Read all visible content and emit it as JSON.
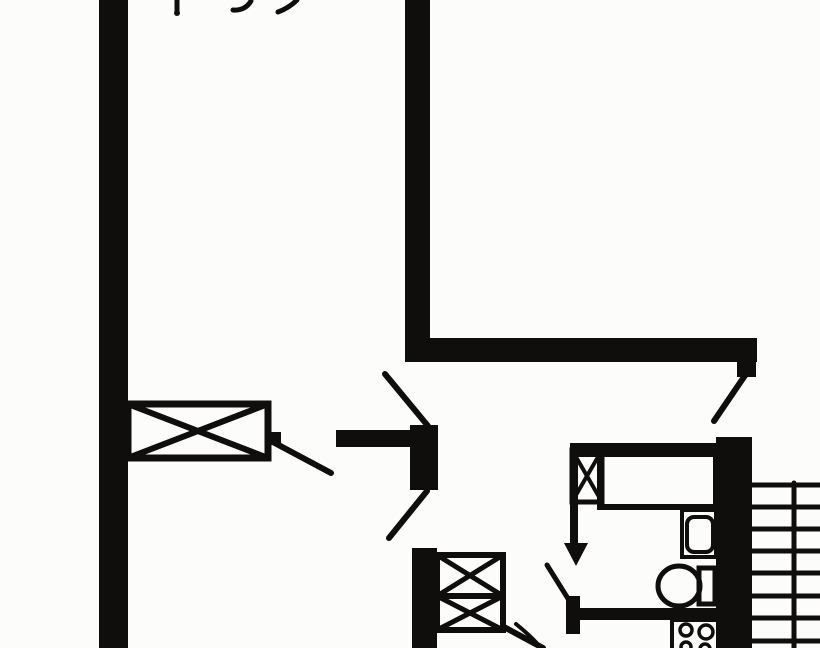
{
  "meta": {
    "document_type": "floor-plan-scan",
    "canvas": {
      "width": 820,
      "height": 648
    },
    "ink_color": "#0f0e0c",
    "paper_color": "#fcfcfa",
    "visible_text": []
  },
  "plan": {
    "elements": [
      {
        "name": "left-wall",
        "kind": "rect",
        "x": 99,
        "y": 0,
        "w": 29,
        "h": 648,
        "fill": true
      },
      {
        "name": "entry-hall-wall-vertical",
        "kind": "rect",
        "x": 405,
        "y": 0,
        "w": 25,
        "h": 362,
        "fill": true
      },
      {
        "name": "entry-hall-wall-horizontal",
        "kind": "rect",
        "x": 405,
        "y": 338,
        "w": 352,
        "h": 24,
        "fill": true
      },
      {
        "name": "stair-door-jamb",
        "kind": "rect",
        "x": 737,
        "y": 362,
        "w": 19,
        "h": 15,
        "fill": true
      },
      {
        "name": "right-wall",
        "kind": "rect",
        "x": 716,
        "y": 437,
        "w": 36,
        "h": 211,
        "fill": true
      },
      {
        "name": "bathroom-top-wall",
        "kind": "rect",
        "x": 570,
        "y": 443,
        "w": 146,
        "h": 14,
        "fill": true
      },
      {
        "name": "bathroom-left-wall",
        "kind": "rect",
        "x": 570,
        "y": 443,
        "w": 8,
        "h": 104,
        "fill": true
      },
      {
        "name": "bathroom-bottom-wall",
        "kind": "rect",
        "x": 578,
        "y": 608,
        "w": 138,
        "h": 12,
        "fill": true
      },
      {
        "name": "hallway-bottom-wall",
        "kind": "rect",
        "x": 412,
        "y": 548,
        "w": 25,
        "h": 100,
        "fill": true
      },
      {
        "name": "center-door-post",
        "kind": "rect",
        "x": 410,
        "y": 425,
        "w": 28,
        "h": 65,
        "fill": true
      },
      {
        "name": "living-room-wall-stub",
        "kind": "rect",
        "x": 336,
        "y": 430,
        "w": 74,
        "h": 17,
        "fill": true
      },
      {
        "name": "bathroom-door-post",
        "kind": "rect",
        "x": 566,
        "y": 596,
        "w": 14,
        "h": 38,
        "fill": true
      },
      {
        "name": "living-room-door-hinge",
        "kind": "rect",
        "x": 268,
        "y": 432,
        "w": 13,
        "h": 13,
        "fill": true
      },
      {
        "name": "window-hatch-box",
        "kind": "xbox",
        "x": 128,
        "y": 404,
        "w": 140,
        "h": 54,
        "sw": 7
      },
      {
        "name": "bathroom-shaft-hatch",
        "kind": "xbox",
        "x": 572,
        "y": 450,
        "w": 30,
        "h": 52,
        "sw": 5
      },
      {
        "name": "hallway-shaft-hatch",
        "kind": "xbox2",
        "x": 437,
        "y": 555,
        "w": 66,
        "h": 75,
        "divider": 596,
        "sw": 6
      },
      {
        "name": "bathtub",
        "kind": "rect",
        "x": 600,
        "y": 450,
        "w": 116,
        "h": 57,
        "sw": 6
      },
      {
        "name": "washbasin",
        "kind": "rect",
        "x": 682,
        "y": 510,
        "w": 34,
        "h": 47,
        "sw": 4
      },
      {
        "name": "washbasin-bowl",
        "kind": "rect",
        "x": 687,
        "y": 517,
        "w": 26,
        "h": 35,
        "rx": 7,
        "sw": 4
      },
      {
        "name": "toilet-bowl",
        "kind": "ellipse",
        "cx": 679,
        "cy": 586,
        "rx": 21,
        "ry": 20,
        "sw": 5
      },
      {
        "name": "toilet-tank",
        "kind": "rect",
        "x": 699,
        "y": 568,
        "w": 16,
        "h": 36,
        "sw": 5
      },
      {
        "name": "stove",
        "kind": "rect",
        "x": 672,
        "y": 620,
        "w": 46,
        "h": 34,
        "sw": 4
      },
      {
        "name": "stove-burner",
        "kind": "circle",
        "cx": 686,
        "cy": 630,
        "r": 6,
        "sw": 3.5
      },
      {
        "name": "stove-burner",
        "kind": "circle",
        "cx": 706,
        "cy": 632,
        "r": 7,
        "sw": 3.5
      },
      {
        "name": "stove-burner",
        "kind": "circle",
        "cx": 686,
        "cy": 647,
        "r": 5,
        "sw": 3.5
      },
      {
        "name": "stove-burner",
        "kind": "circle",
        "cx": 705,
        "cy": 649,
        "r": 5,
        "sw": 3.5
      },
      {
        "name": "stair-tread",
        "kind": "line",
        "x1": 750,
        "y1": 485,
        "x2": 820,
        "y2": 485,
        "sw": 5
      },
      {
        "name": "stair-tread",
        "kind": "line",
        "x1": 750,
        "y1": 507,
        "x2": 820,
        "y2": 507,
        "sw": 5
      },
      {
        "name": "stair-tread",
        "kind": "line",
        "x1": 750,
        "y1": 529,
        "x2": 820,
        "y2": 529,
        "sw": 5
      },
      {
        "name": "stair-tread",
        "kind": "line",
        "x1": 750,
        "y1": 551,
        "x2": 820,
        "y2": 551,
        "sw": 5
      },
      {
        "name": "stair-tread",
        "kind": "line",
        "x1": 750,
        "y1": 573,
        "x2": 820,
        "y2": 573,
        "sw": 5
      },
      {
        "name": "stair-tread",
        "kind": "line",
        "x1": 750,
        "y1": 596,
        "x2": 820,
        "y2": 596,
        "sw": 5
      },
      {
        "name": "stair-tread",
        "kind": "line",
        "x1": 750,
        "y1": 618,
        "x2": 820,
        "y2": 618,
        "sw": 5
      },
      {
        "name": "stair-tread",
        "kind": "line",
        "x1": 750,
        "y1": 641,
        "x2": 820,
        "y2": 641,
        "sw": 5
      },
      {
        "name": "stair-stringer",
        "kind": "line",
        "x1": 794,
        "y1": 483,
        "x2": 794,
        "y2": 648,
        "sw": 5
      },
      {
        "name": "stair-door-leaf",
        "kind": "line",
        "x1": 746,
        "y1": 374,
        "x2": 714,
        "y2": 421,
        "sw": 6
      },
      {
        "name": "living-room-upper-door-leaf",
        "kind": "line",
        "x1": 428,
        "y1": 426,
        "x2": 385,
        "y2": 374,
        "sw": 6
      },
      {
        "name": "living-room-lower-door-leaf",
        "kind": "line",
        "x1": 427,
        "y1": 491,
        "x2": 389,
        "y2": 538,
        "sw": 6
      },
      {
        "name": "living-room-door-leaf",
        "kind": "line",
        "x1": 271,
        "y1": 441,
        "x2": 331,
        "y2": 473,
        "sw": 6
      },
      {
        "name": "bathroom-door-leaf",
        "kind": "line",
        "x1": 547,
        "y1": 565,
        "x2": 572,
        "y2": 605,
        "sw": 5
      },
      {
        "name": "kitchen-door-leaf",
        "kind": "line",
        "x1": 504,
        "y1": 627,
        "x2": 543,
        "y2": 648,
        "sw": 6
      },
      {
        "name": "kitchen-door-swing-arc",
        "kind": "path",
        "d": "M516,624 Q532,637 541,648",
        "sw": 4
      },
      {
        "name": "entry-direction-arrow",
        "kind": "polygon",
        "points": "564,543 588,543 576,566",
        "fill": true
      },
      {
        "name": "top-door-tick",
        "kind": "line",
        "x1": 177,
        "y1": 0,
        "x2": 177,
        "y2": 12,
        "sw": 5
      },
      {
        "name": "top-door-tick-dot",
        "kind": "circle",
        "cx": 177,
        "cy": 13,
        "r": 3,
        "fill": true
      },
      {
        "name": "top-swing-arc-left",
        "kind": "path",
        "d": "M251,1 Q245,11 233,10",
        "sw": 5
      },
      {
        "name": "top-swing-arc-right",
        "kind": "path",
        "d": "M278,12 Q289,8 297,0",
        "sw": 5
      }
    ]
  }
}
